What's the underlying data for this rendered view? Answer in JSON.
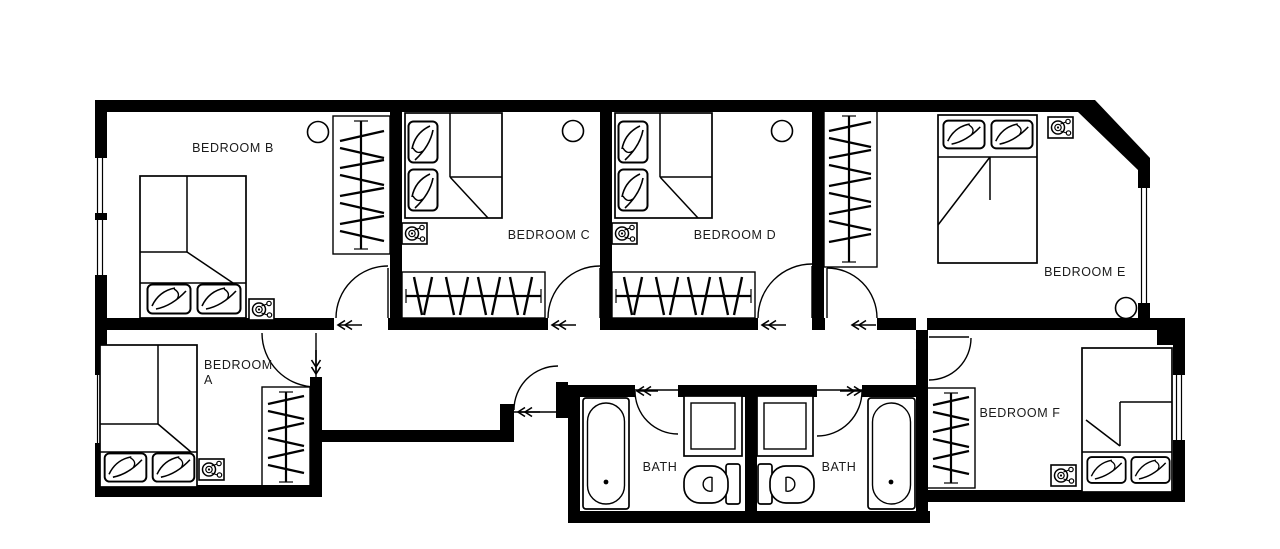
{
  "colors": {
    "walls": "#000000",
    "labels": "#1a1a1a",
    "background": "#ffffff"
  },
  "rooms": {
    "bedroom_b": {
      "name": "BEDROOM B",
      "features": [
        "double-bed",
        "wardrobe",
        "ceiling-light",
        "smoke-detector",
        "door",
        "windows"
      ]
    },
    "bedroom_c": {
      "name": "BEDROOM C",
      "features": [
        "double-bed",
        "wardrobe",
        "ceiling-light",
        "smoke-detector",
        "door"
      ]
    },
    "bedroom_d": {
      "name": "BEDROOM D",
      "features": [
        "double-bed",
        "wardrobe",
        "ceiling-light",
        "smoke-detector",
        "door"
      ]
    },
    "bedroom_e": {
      "name": "BEDROOM E",
      "features": [
        "double-bed",
        "wardrobe",
        "ceiling-light",
        "smoke-detector",
        "door",
        "window"
      ]
    },
    "bedroom_a": {
      "name": "BEDROOM",
      "name_line2": "A",
      "features": [
        "double-bed",
        "wardrobe",
        "smoke-detector",
        "door",
        "window"
      ]
    },
    "bedroom_f": {
      "name": "BEDROOM F",
      "features": [
        "double-bed",
        "wardrobe",
        "smoke-detector",
        "door",
        "window"
      ]
    },
    "bath_left": {
      "name": "BATH",
      "features": [
        "bathtub",
        "shower",
        "toilet",
        "door"
      ]
    },
    "bath_right": {
      "name": "BATH",
      "features": [
        "bathtub",
        "shower",
        "toilet",
        "door"
      ]
    }
  }
}
